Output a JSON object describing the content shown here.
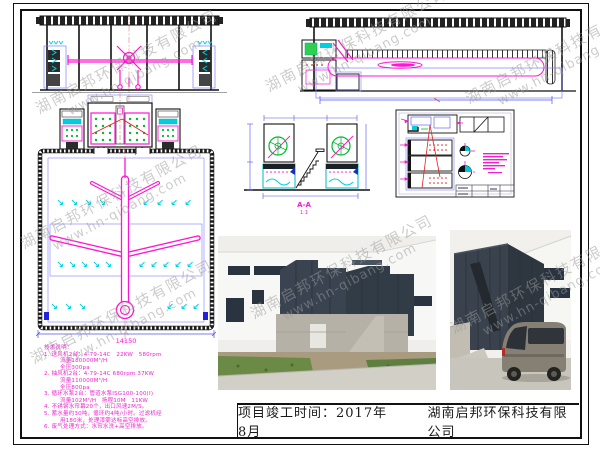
{
  "title_bar": {
    "completion_label": "项目竣工时间：2017年8月",
    "company": "湖南启邦环保科技有限公司"
  },
  "watermark": {
    "line1": "湖南启邦环保科技有限公司",
    "line2": "www.hn-qibang.com"
  },
  "notes": {
    "lines": [
      "技术说明：",
      "1. 送风机2台：4-79-14C　22KW　580rpm",
      "流量180000M³/H",
      "全压300pa",
      "2. 抽风机2台：4-79-14C 680rpm 37KW",
      "流量110000M³/H",
      "全压800pa",
      "3. 循环水泵2台：管道水泵ISG100-100(I)",
      "流量102M³/H　扬程10M　11KW",
      "4. 不锈钢水帘幕20个，出口风速2M/S。",
      "5. 蓄水量约30吨，循环约4吨/小时。过滤机经",
      "用180米，处理漆雾达标高空排放。",
      "6. 废气处理方式：水帘水洗+高空排放。"
    ]
  },
  "drawings": {
    "plan_dimension": "14150",
    "section_label": "A-A",
    "section_scale": "1:1"
  },
  "colors": {
    "cad_magenta": "#ff14d2",
    "cad_cyan": "#00cfe0",
    "cad_green": "#00b830",
    "cad_blue": "#7070ff",
    "cad_red": "#e22222",
    "notes_magenta": "#ee22cc"
  }
}
